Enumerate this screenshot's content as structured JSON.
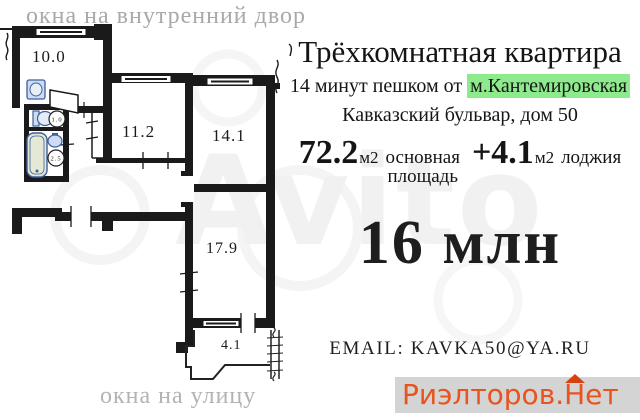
{
  "plan": {
    "caption_top": "окна на внутренний двор",
    "caption_bottom": "окна на улицу",
    "rooms": {
      "kitchen": "10.0",
      "room1": "11.2",
      "room2": "14.1",
      "room3": "17.9",
      "loggia": "4.1",
      "wc": "1.0",
      "bath": "2.5"
    }
  },
  "listing": {
    "title": "Трёхкомнатная квартира",
    "walk_prefix": "14 минут пешком от ",
    "metro": "м.Кантемировская",
    "address": "Кавказский бульвар, дом 50",
    "area_main_value": "72.2",
    "area_main_unit": "м2",
    "area_main_label_line1": "основная",
    "area_main_label_line2": "площадь",
    "area_extra_value": "+4.1",
    "area_extra_unit": "м2",
    "area_extra_label": "лоджия",
    "price": "16 млн",
    "email": "EMAIL: KAVKA50@YA.RU"
  },
  "watermarks": {
    "site": "Avito",
    "realtor_before": "Риэлторов.",
    "realtor_roof_letter": "Н",
    "realtor_after": "ет"
  },
  "colors": {
    "metro_highlight": "#8deb8d",
    "realtor_orange": "#e8541e",
    "realtor_roof": "#d64312",
    "strip_gray": "#d4d4d4",
    "wall_black": "#1a1a1a",
    "caption_gray": "#a9a9a9",
    "fixture_blue": "#cddcf0",
    "tub_green": "#e3e9d5"
  }
}
